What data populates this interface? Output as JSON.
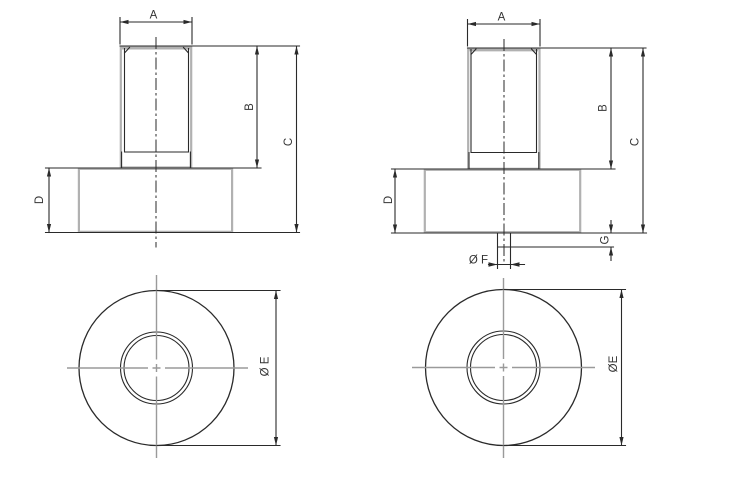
{
  "drawing": {
    "views": {
      "side_left": {
        "dim_a": "A",
        "dim_b": "B",
        "dim_c": "C",
        "dim_d": "D"
      },
      "side_right": {
        "dim_a": "A",
        "dim_b": "B",
        "dim_c": "C",
        "dim_d": "D",
        "dim_f": "Ø F",
        "dim_g": "G"
      },
      "bottom_left": {
        "dim_e": "Ø E"
      },
      "bottom_right": {
        "dim_e": "ØE"
      }
    },
    "colors": {
      "object_line": "#2a2a2a",
      "auxiliary_line": "#b1b1b1",
      "center_line": "#9a9a9a",
      "label_text": "#333333",
      "background": "#ffffff"
    }
  }
}
